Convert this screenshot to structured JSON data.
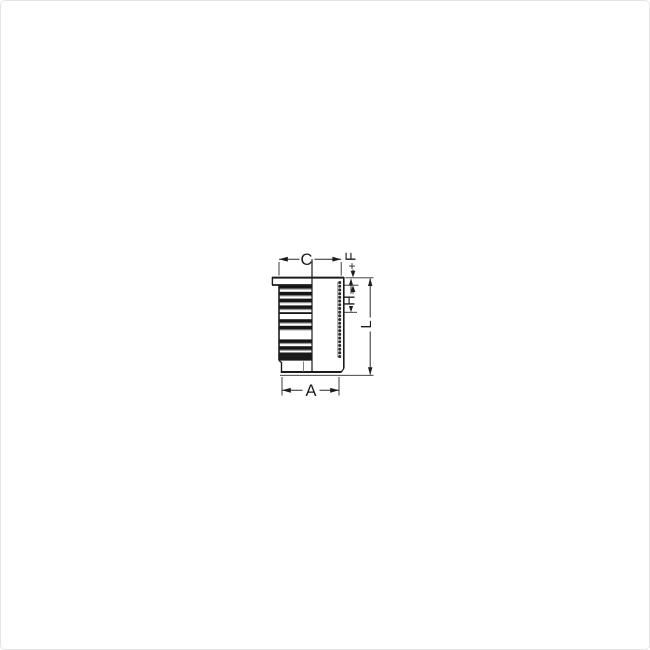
{
  "figure": {
    "type": "technical-drawing",
    "subject": "cylinder-liner-side-view-half-section",
    "background_color": "#ffffff",
    "line_color": "#1c1c1c",
    "rib_dark_color": "#161616",
    "rib_mid_color": "#8a8a8a",
    "dimensions": [
      {
        "id": "C",
        "label": "C",
        "rotated": false,
        "position": "top"
      },
      {
        "id": "F",
        "label": "F",
        "tolerance_mark": "+",
        "rotated": true,
        "position": "top-right"
      },
      {
        "id": "H",
        "label": "H",
        "rotated": true,
        "position": "right"
      },
      {
        "id": "L",
        "label": "L",
        "rotated": true,
        "position": "far-right"
      },
      {
        "id": "A",
        "label": "A",
        "rotated": false,
        "position": "bottom"
      }
    ]
  }
}
